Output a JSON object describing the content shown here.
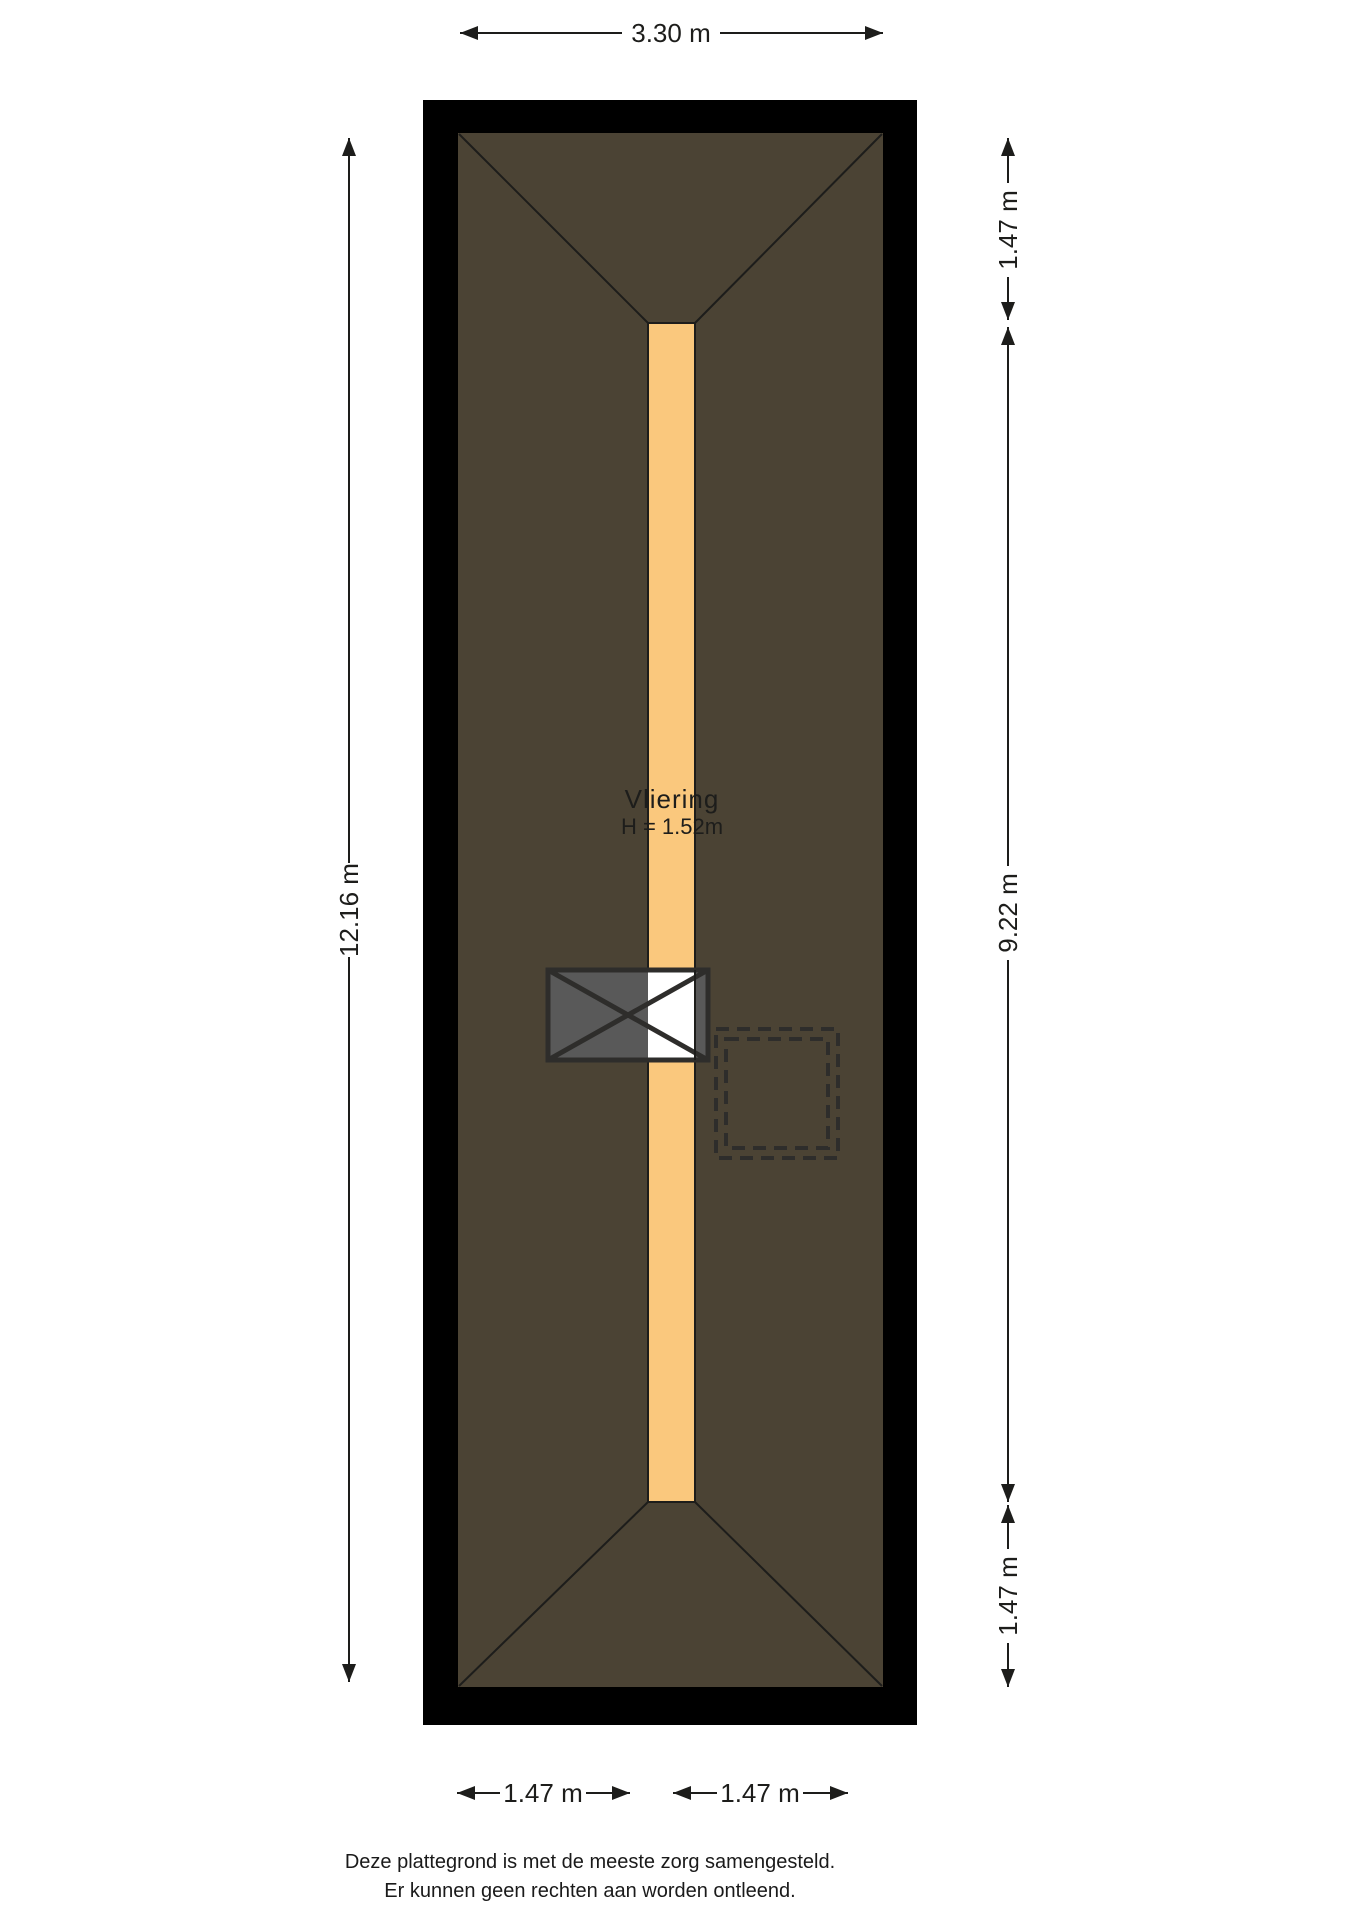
{
  "plan": {
    "room": {
      "name": "Vliering",
      "height_label": "H = 1.52m"
    },
    "dimensions": {
      "top_width": "3.30 m",
      "left_height": "12.16 m",
      "right_top": "1.47 m",
      "right_middle": "9.22 m",
      "right_bottom": "1.47 m",
      "bottom_left": "1.47 m",
      "bottom_right": "1.47 m"
    },
    "footer": {
      "line1": "Deze plattegrond is met de meeste zorg samengesteld.",
      "line2": "Er kunnen geen rechten aan worden ontleend."
    },
    "colors": {
      "background": "#ffffff",
      "wall": "#000000",
      "roof_area": "#4b4334",
      "floor_strip": "#fac87d",
      "hatch_fill": "#595959",
      "hatch_overlap": "#ffffff",
      "hatch_stroke": "#2e2d2b",
      "line": "#1d1d1b"
    }
  }
}
